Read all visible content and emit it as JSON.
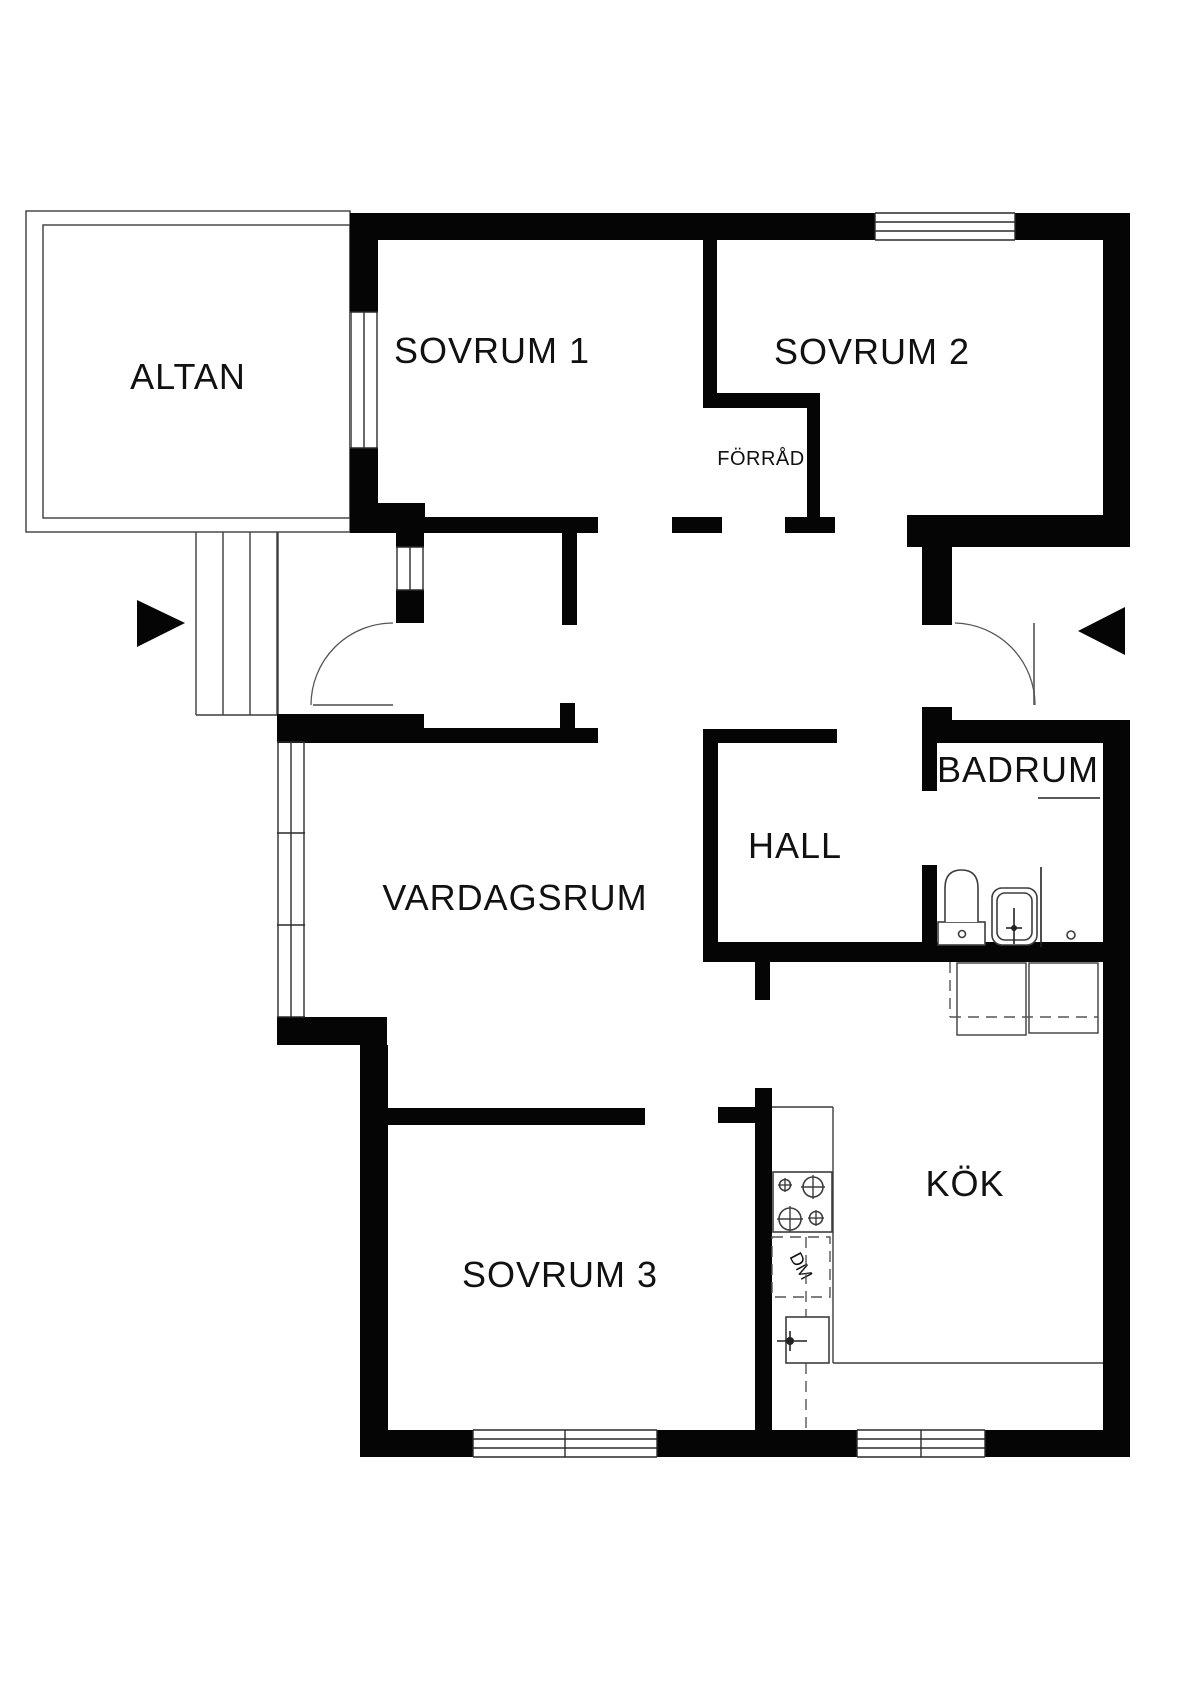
{
  "plan": {
    "type": "floorplan",
    "rooms": {
      "altan": {
        "label": "ALTAN"
      },
      "sovrum1": {
        "label": "SOVRUM 1"
      },
      "sovrum2": {
        "label": "SOVRUM 2"
      },
      "forrad": {
        "label": "FÖRRÅD"
      },
      "hall": {
        "label": "HALL"
      },
      "badrum": {
        "label": "BADRUM"
      },
      "vardagsrum": {
        "label": "VARDAGSRUM"
      },
      "sovrum3": {
        "label": "SOVRUM 3"
      },
      "kok": {
        "label": "KÖK"
      }
    },
    "appliances": {
      "dishwasher_label": "DM"
    },
    "colors": {
      "wall": "#050505",
      "line": "#3d3d3d",
      "background": "#ffffff"
    }
  }
}
